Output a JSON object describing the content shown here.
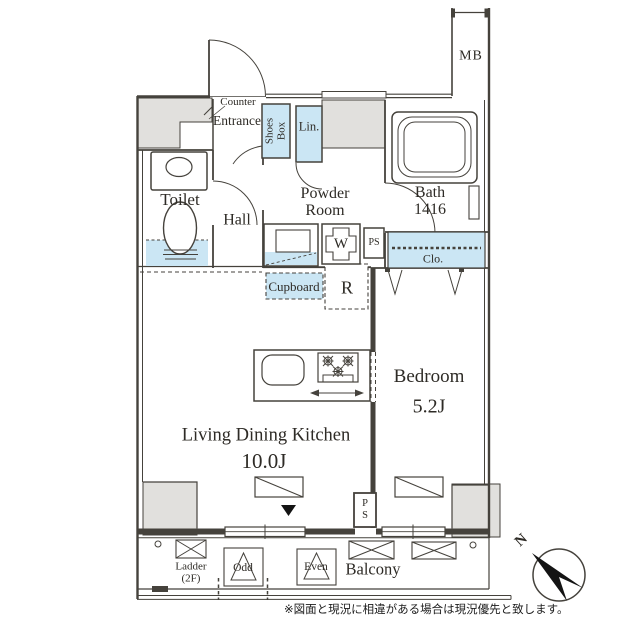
{
  "colors": {
    "line": "#45423c",
    "wall_gray": "#e1e0dd",
    "fixture_blue": "#cbe6f4",
    "text": "#2e2b26",
    "black": "#141414"
  },
  "rooms": {
    "meter_box": "MB",
    "counter": "Counter",
    "entrance": "Entrance",
    "shoes_box": "Shoes\nBox",
    "linen": "Lin.",
    "toilet": "Toilet",
    "hall": "Hall",
    "powder_room": "Powder\nRoom",
    "bath": "Bath\n1416",
    "pipe_space_1": "PS",
    "closet": "Clo.",
    "cupboard": "Cupboard",
    "refrigerator": "R",
    "washer": "W",
    "bedroom": "Bedroom",
    "bedroom_size": "5.2J",
    "ldk": "Living Dining Kitchen",
    "ldk_size": "10.0J",
    "pipe_space_2": "P\nS",
    "balcony": "Balcony",
    "ladder": "Ladder\n(2F)",
    "hatch_odd": "Odd",
    "hatch_even": "Even"
  },
  "compass": {
    "north": "N"
  },
  "note": "※図面と現況に相違がある場合は現況優先と致します。"
}
